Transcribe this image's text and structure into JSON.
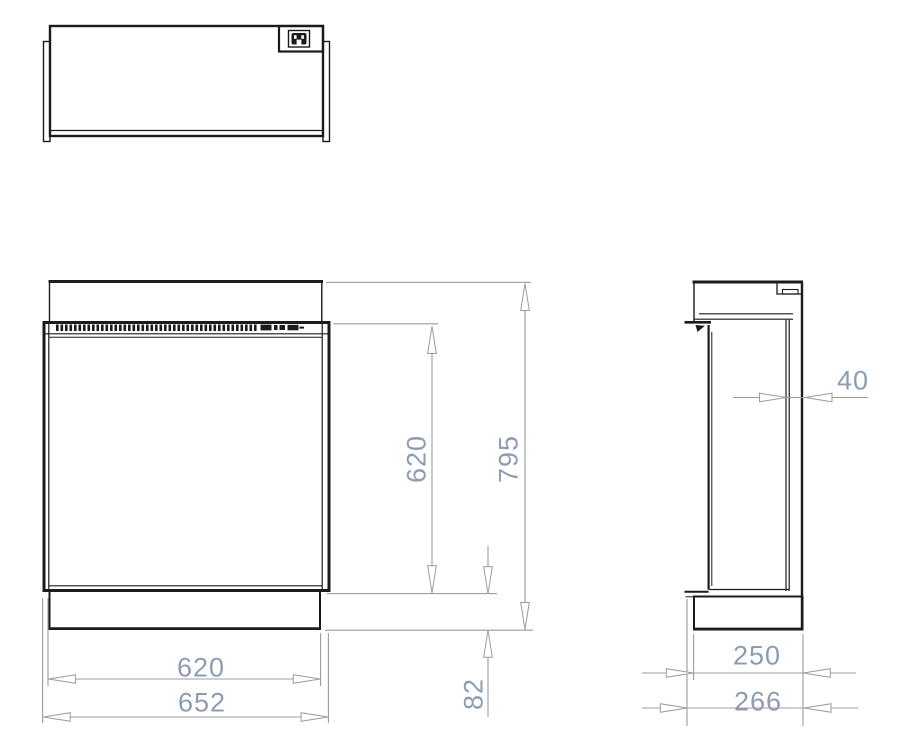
{
  "document": {
    "kind": "technical-dimension-drawing",
    "views": [
      "top-view",
      "front-view",
      "side-view"
    ]
  },
  "colors": {
    "outline": "#1b1b1b",
    "dim_line": "#9c9c9c",
    "dim_text": "#8d9cb2",
    "background": "#ffffff"
  },
  "icons": {
    "power_inlet": "power-inlet-icon"
  },
  "dimensions": {
    "front_width_inner": "620",
    "front_width_outer": "652",
    "front_glass_height": "620",
    "front_total_height": "795",
    "base_height": "82",
    "side_rear_gap": "40",
    "side_depth_inner": "250",
    "side_depth_outer": "266"
  }
}
